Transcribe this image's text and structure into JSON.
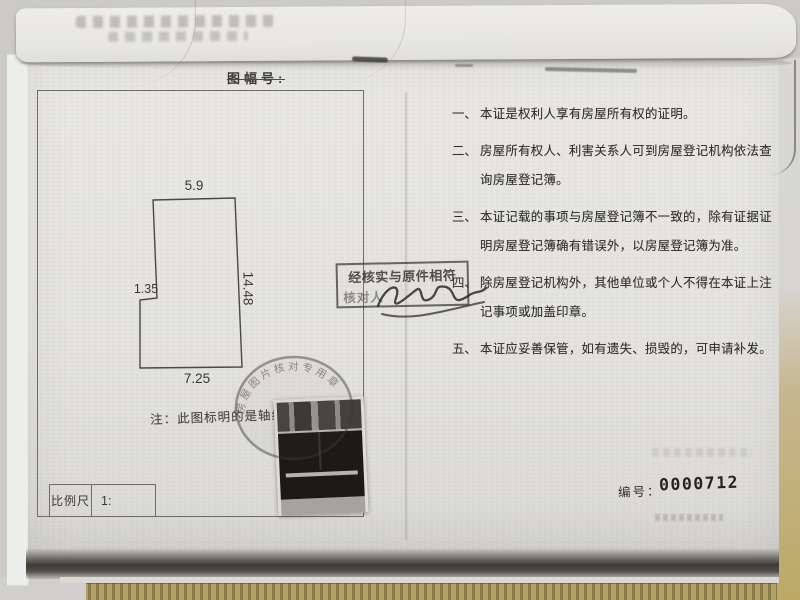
{
  "header": {
    "map_sheet_label": "图幅号:"
  },
  "plan": {
    "dim_top": "5.9",
    "dim_right": "14.48",
    "dim_step": "1.35",
    "dim_bottom": "7.25",
    "note": "注：此图标明的是轴线尺寸",
    "scale_label": "比例尺",
    "scale_value": "1:"
  },
  "notes": [
    {
      "num": "一、",
      "lines": [
        "本证是权利人享有房屋所有权的证明。"
      ]
    },
    {
      "num": "二、",
      "lines": [
        "房屋所有权人、利害关系人可到房屋登记机构依法查",
        "询房屋登记簿。"
      ]
    },
    {
      "num": "三、",
      "lines": [
        "本证记载的事项与房屋登记簿不一致的，除有证据证",
        "明房屋登记簿确有错误外，以房屋登记簿为准。"
      ]
    },
    {
      "num": "四、",
      "lines": [
        "除房屋登记机构外，其他单位或个人不得在本证上注",
        "记事项或加盖印章。"
      ]
    },
    {
      "num": "五、",
      "lines": [
        "本证应妥善保管，如有遗失、损毁的，可申请补发。"
      ]
    }
  ],
  "stamps": {
    "verify_line1": "经核实与原件相符",
    "verify_line2_label": "核对人",
    "round_stamp_text": "房屋图片核对专用章"
  },
  "serial": {
    "label": "编号：",
    "number": "0000712"
  },
  "colors": {
    "paper": "#e6e5e2",
    "ink": "#312f2a",
    "stamp_ink": "#3f3c36",
    "table_edge": "#b2a164"
  }
}
